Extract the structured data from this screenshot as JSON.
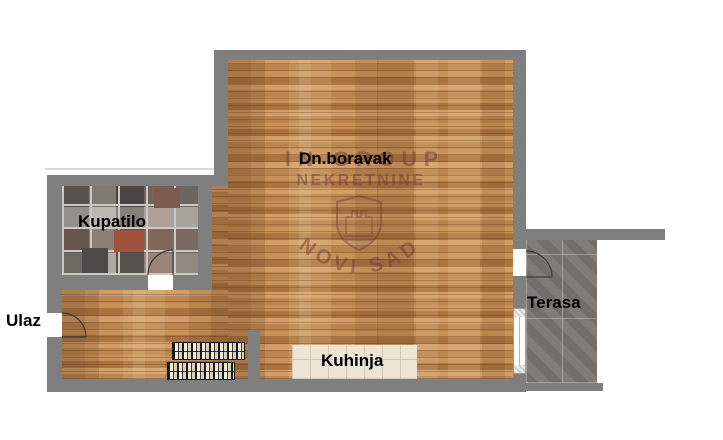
{
  "plan": {
    "type": "apartment-floorplan",
    "rooms": {
      "living": {
        "label": "Dn.boravak"
      },
      "bathroom": {
        "label": "Kupatilo"
      },
      "entrance": {
        "label": "Ulaz"
      },
      "kitchen": {
        "label": "Kuhinja"
      },
      "terrace": {
        "label": "Terasa"
      }
    },
    "watermark": {
      "line1": "IN GROUP",
      "line2": "NEKRETNINE",
      "arc_text": "NOVI SAD",
      "logo": "shield-castle-icon",
      "color": "#6b3a3a"
    },
    "colors": {
      "wall": "#7f7f7f",
      "wood_floor": "#c58b57",
      "bathroom_tile": "#8d8680",
      "terrace_tile": "#7b7571",
      "kitchen_tile": "#ece4d5",
      "label": "#000000",
      "background": "#ffffff"
    }
  }
}
